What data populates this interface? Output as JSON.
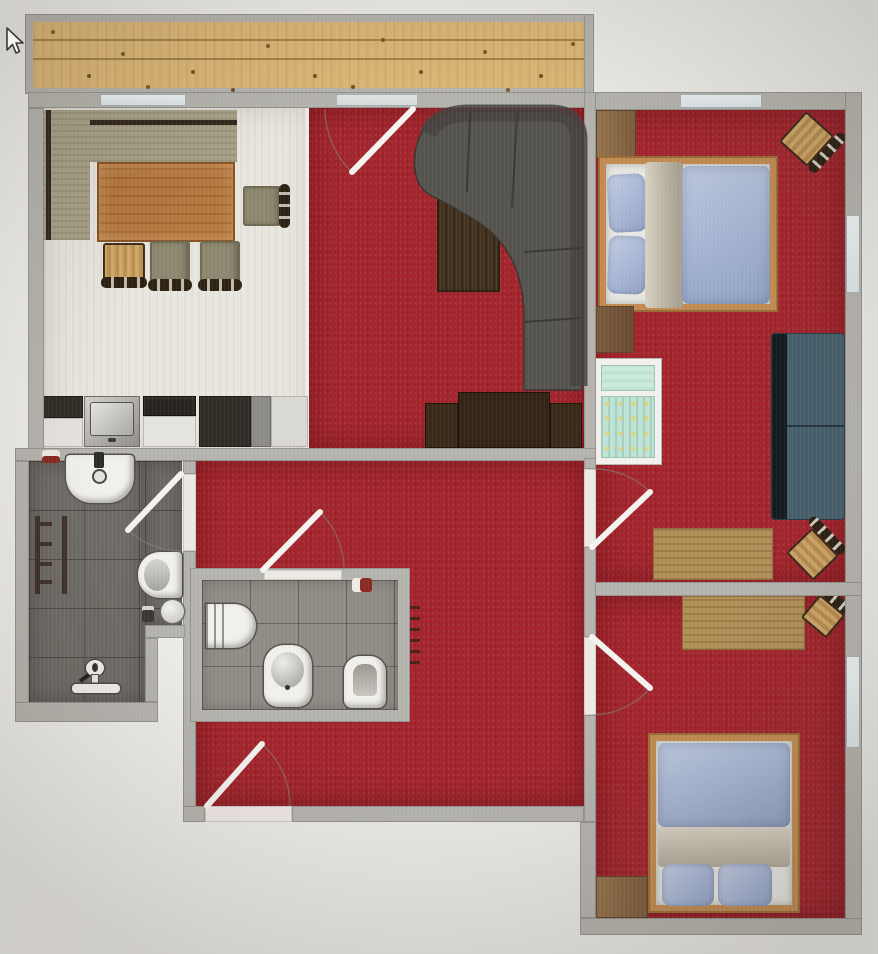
{
  "scene": {
    "type": "2d-floor-plan-top-view",
    "cursor": "arrow-pointer",
    "note": "apartment floor plan with balcony"
  },
  "palette": {
    "carpet_red": "#a3242c",
    "wall_gray": "#b6b4ae",
    "balcony_wood": "#ddb877",
    "kitchen_floor": "#e9e7e0",
    "tile_dark": "#6f6b66",
    "tile_light": "#908c86",
    "sofa_dark_gray": "#56544f",
    "sofa_slate_blue": "#47606d",
    "bed_frame_wood": "#c28c52",
    "duvet_blue": "#a7b6d4",
    "blanket_beige": "#cfc8b8",
    "furniture_wood": "#b5773f",
    "crib_teal": "#bfe3d5",
    "fixture_white": "#f2f1ed"
  },
  "rooms": {
    "balcony": {
      "name": "Balcony",
      "floor": "wood planks"
    },
    "kitchen_dining": {
      "name": "Kitchen / Dining",
      "floor": "light laminate",
      "furniture": [
        "corner bench",
        "dining table",
        "dining chair right",
        "dining chair A",
        "dining chair B",
        "small wooden chair",
        "kitchen counter",
        "kitchen sink",
        "cooktop",
        "tall cabinet"
      ]
    },
    "living_room": {
      "name": "Living Room",
      "floor": "red carpet",
      "furniture": [
        "curved corner sofa",
        "coffee table",
        "tv sideboard"
      ]
    },
    "hallway": {
      "name": "Hallway",
      "floor": "red carpet",
      "furniture": [
        "radiator"
      ]
    },
    "bathroom": {
      "name": "Bathroom",
      "floor": "dark gray tile",
      "furniture": [
        "washbasin",
        "toilet",
        "towel radiator",
        "round stool",
        "toilet roll holder",
        "bath mixer",
        "soap dish"
      ]
    },
    "wc": {
      "name": "WC / Shower room",
      "floor": "gray tile",
      "furniture": [
        "shower tray",
        "bidet",
        "toilet",
        "soap dish"
      ]
    },
    "bedroom_1": {
      "name": "Bedroom 1",
      "floor": "red carpet",
      "furniture": [
        "double bed",
        "wardrobe",
        "dresser",
        "crib",
        "sofa",
        "desk",
        "corner chair",
        "desk chair"
      ]
    },
    "bedroom_2": {
      "name": "Bedroom 2",
      "floor": "red carpet",
      "furniture": [
        "single bed",
        "wardrobe",
        "desk",
        "corner chair"
      ]
    }
  },
  "doors": [
    {
      "from": "living_room",
      "to": "balcony"
    },
    {
      "from": "hallway",
      "to": "bathroom"
    },
    {
      "from": "wc",
      "to": "hallway"
    },
    {
      "from": "hallway",
      "to": "outside"
    },
    {
      "from": "hallway",
      "to": "bedroom_1"
    },
    {
      "from": "hallway",
      "to": "bedroom_2"
    }
  ],
  "windows": [
    {
      "room": "kitchen_dining",
      "wall": "top"
    },
    {
      "room": "living_room",
      "wall": "top",
      "type": "balcony door"
    },
    {
      "room": "bedroom_1",
      "wall": "top"
    },
    {
      "room": "bedroom_1",
      "wall": "right"
    },
    {
      "room": "bedroom_2",
      "wall": "right"
    }
  ]
}
